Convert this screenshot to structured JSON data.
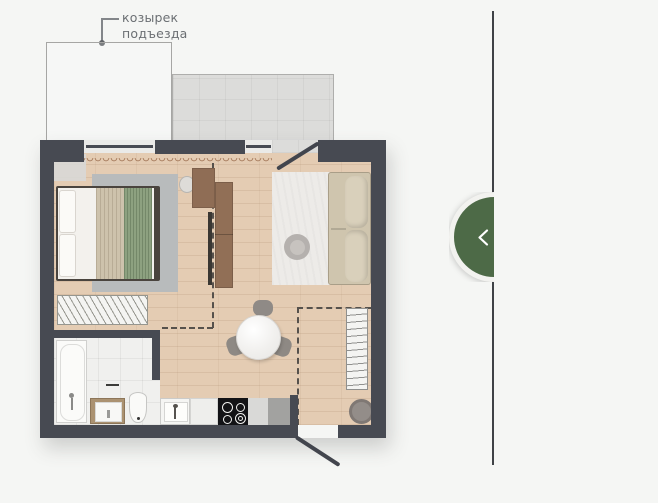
{
  "canvas": {
    "background": "#f5f6f4"
  },
  "annotation": {
    "line1": "козырек",
    "line2": "подъезда",
    "color": "#6b6f73"
  },
  "plan": {
    "colors": {
      "wall": "#474a52",
      "wood_floor": "#e4ccb3",
      "balcony_floor": "#dcdcda",
      "bedroom_rug": "#b8bbbc",
      "living_rug": "#edebe8",
      "sofa": "#cfc5ae",
      "blanket_green": "#8da180",
      "blanket_tan": "#cdc2ac",
      "furniture_wood": "#8f6d55",
      "bathroom_tile": "#f0f0ee",
      "cooktop": "#131316"
    }
  },
  "panel": {
    "divider_color": "#3f4246",
    "toggle": {
      "color": "#4d6a47",
      "icon": "chevron-left"
    }
  }
}
